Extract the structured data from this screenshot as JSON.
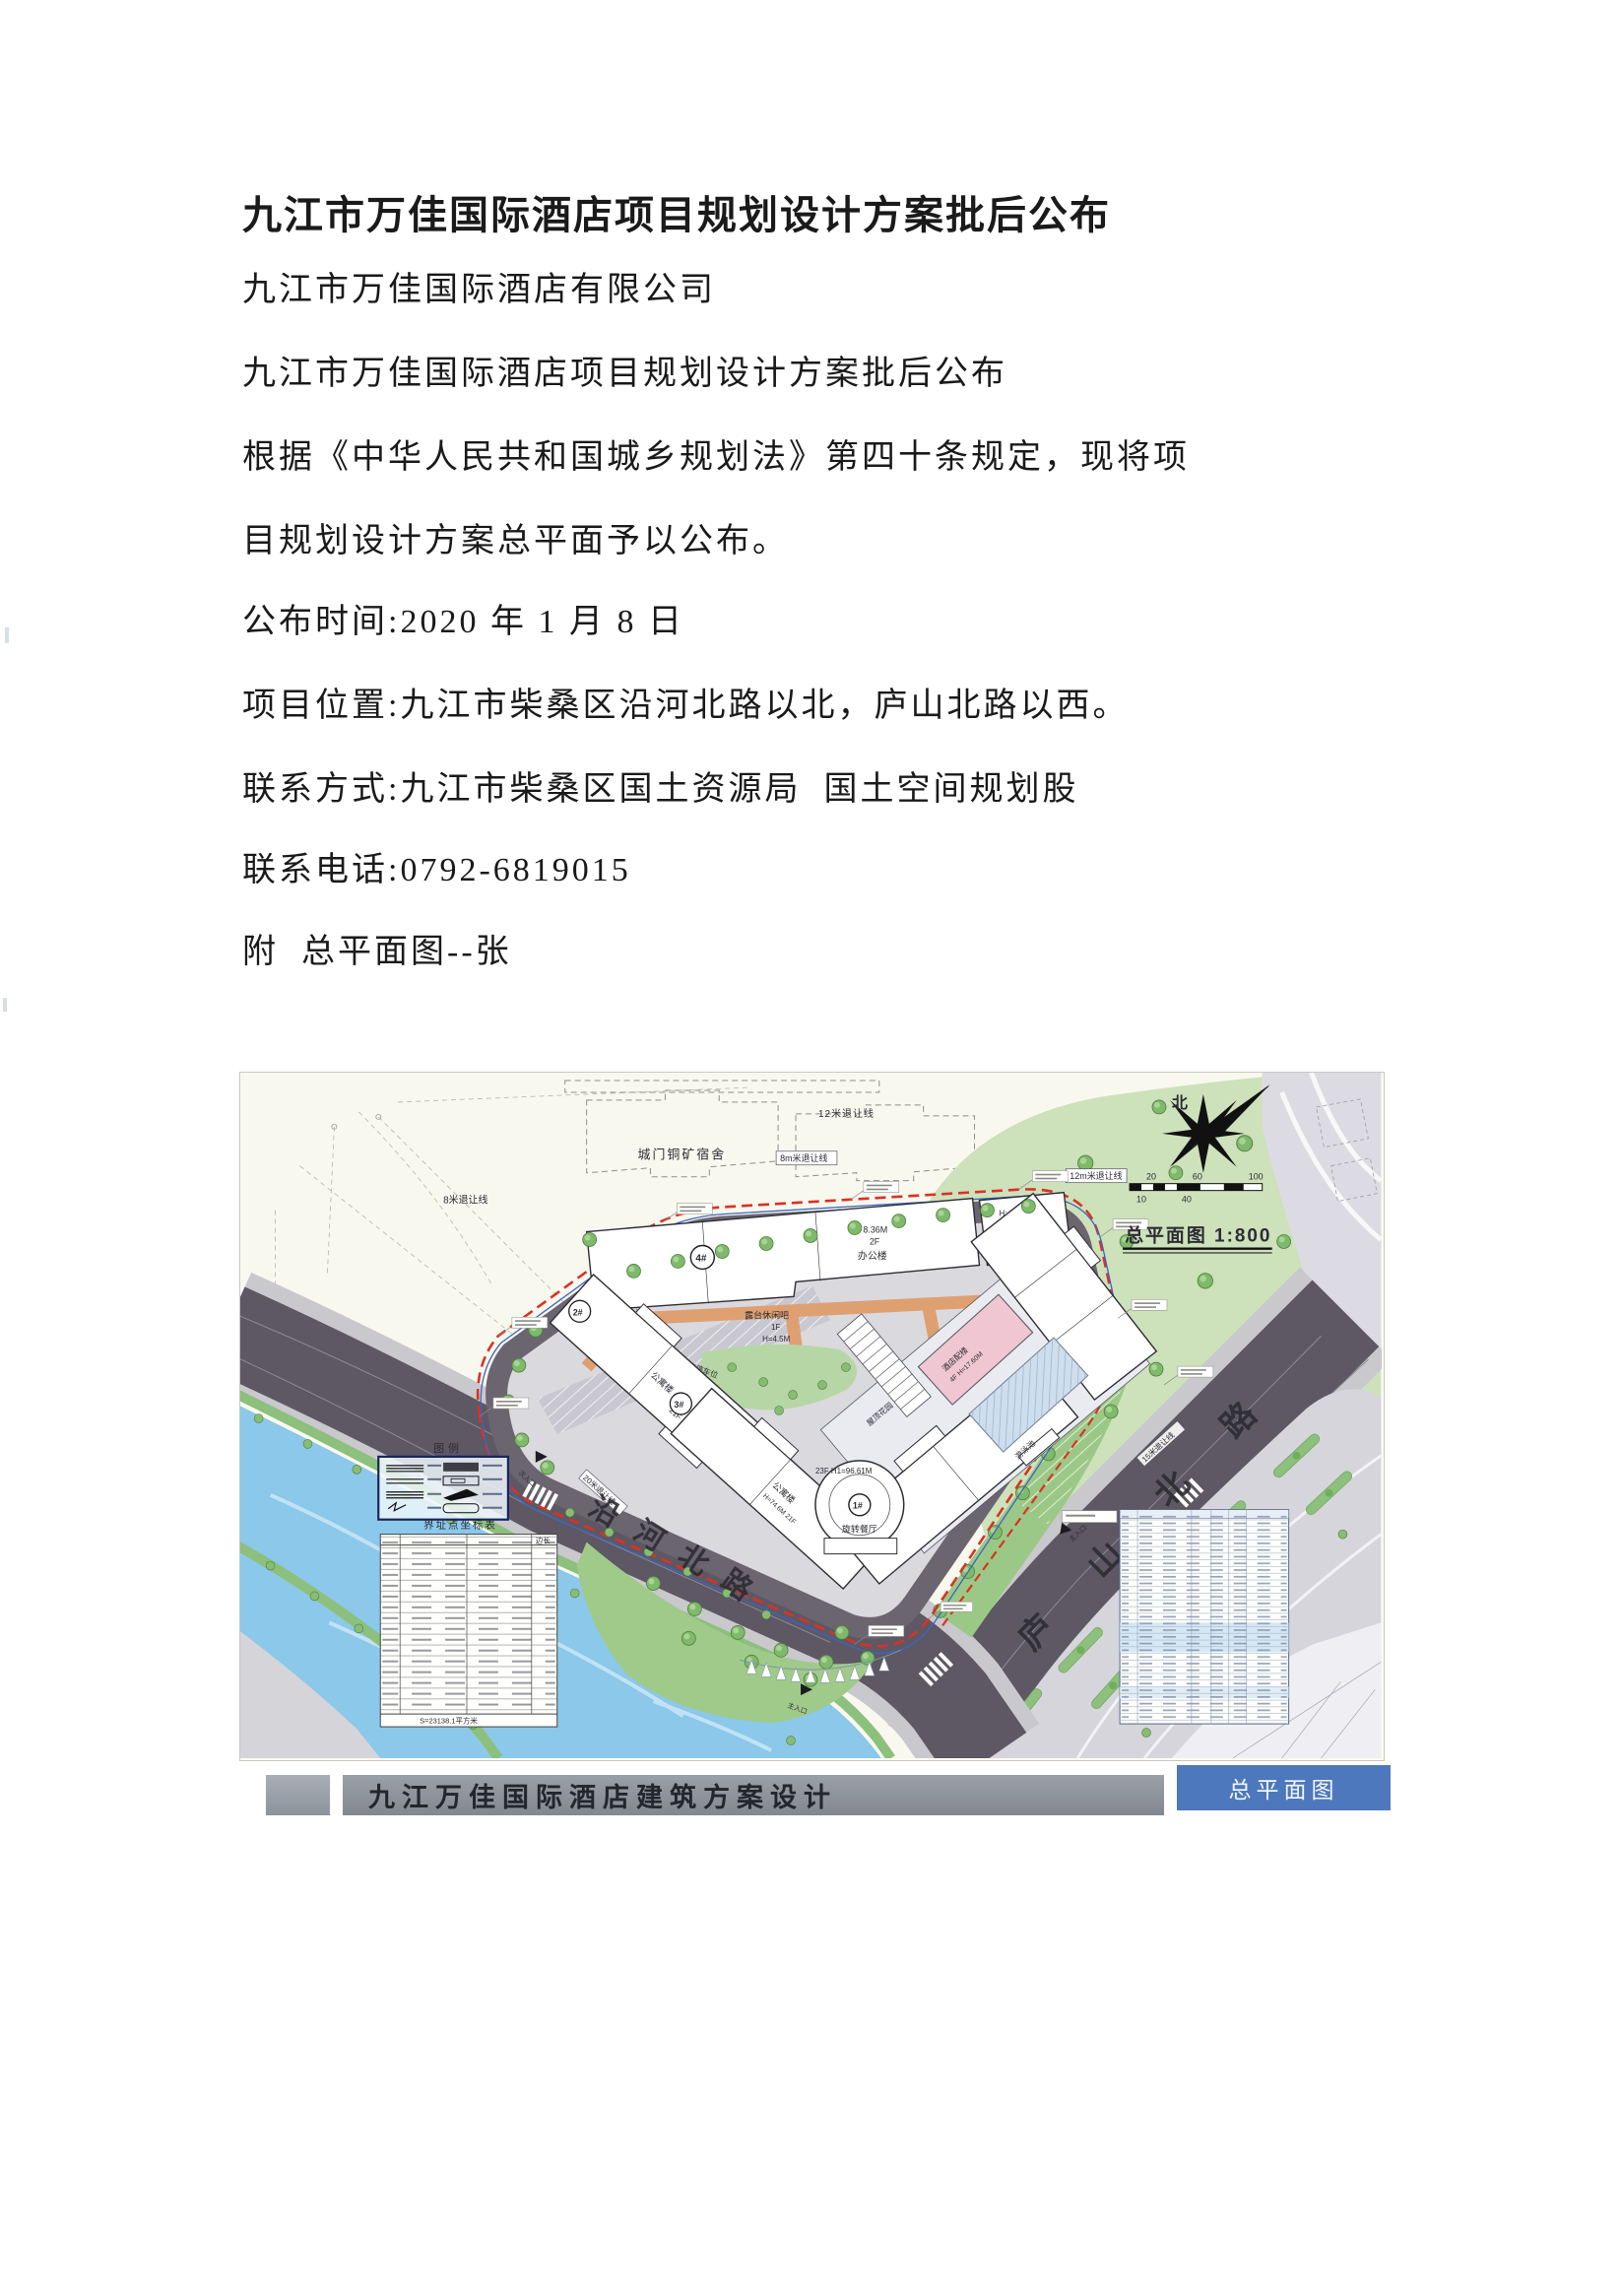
{
  "document": {
    "title": "九江市万佳国际酒店项目规划设计方案批后公布",
    "company": "九江市万佳国际酒店有限公司",
    "subtitle": "九江市万佳国际酒店项目规划设计方案批后公布",
    "para_line1": "根据《中华人民共和国城乡规划法》第四十条规定，现将项",
    "para_line2": "目规划设计方案总平面予以公布。",
    "publish_date": "公布时间:2020 年 1 月 8 日",
    "location": "项目位置:九江市柴桑区沿河北路以北，庐山北路以西。",
    "contact": "联系方式:九江市柴桑区国土资源局  国土空间规划股",
    "phone": "联系电话:0792-6819015",
    "attachment": "附  总平面图--张"
  },
  "plan": {
    "title": "总平面图 1:800",
    "north_label": "北",
    "scale_ticks": {
      "t10": "10",
      "t20": "20",
      "t40": "40",
      "t60": "60",
      "t100": "100"
    },
    "dormitory": "城门铜矿宿舍",
    "setback_12": "12米退让线",
    "setback_8m": "8m米退让线",
    "setback_8": "8米退让线",
    "setback_12m": "12m米退让线",
    "setback_20": "20米退让线",
    "setback_15": "15米退让线",
    "road_river": {
      "c1": "沿",
      "c2": "河",
      "c3": "北",
      "c4": "路"
    },
    "road_lushan": {
      "c1": "庐",
      "c2": "山",
      "c3": "北",
      "c4": "路"
    },
    "legend_title": "图例",
    "coord_table_title": "界址点坐标表",
    "coord_col_side": "边长",
    "coord_footer": "S=23138.1平方米",
    "entry_main": "主入口",
    "entry_sub": "次入口",
    "corridor": "连廊",
    "parking_label": "非机动车停车位",
    "buildings": {
      "b1": {
        "tag": "1#",
        "floors": "23F  H1=96.61M",
        "name": "旋转餐厅"
      },
      "b2": {
        "tag": "2#",
        "name": "公寓楼",
        "floors": "21F"
      },
      "b3": {
        "tag": "3#",
        "name": "公寓楼",
        "floors": "H=74.6M  21F"
      },
      "b4": {
        "tag": "4#",
        "height": "H: 8.36M",
        "floors": "2F",
        "name": "办公楼"
      },
      "b5": {
        "tag": "5#",
        "height": "H: 12.54M",
        "floors": "2F"
      },
      "annex": {
        "name": "酒店配楼",
        "info": "4F  H=17.60M"
      },
      "terrace_bar": {
        "name": "露台休闲吧",
        "floors": "1F",
        "height": "H=4.5M"
      },
      "pool": "游泳池",
      "roof_garden": "屋顶花园"
    }
  },
  "footer": {
    "project_title": "九江万佳国际酒店建筑方案设计",
    "tab_label": "总平面图"
  }
}
